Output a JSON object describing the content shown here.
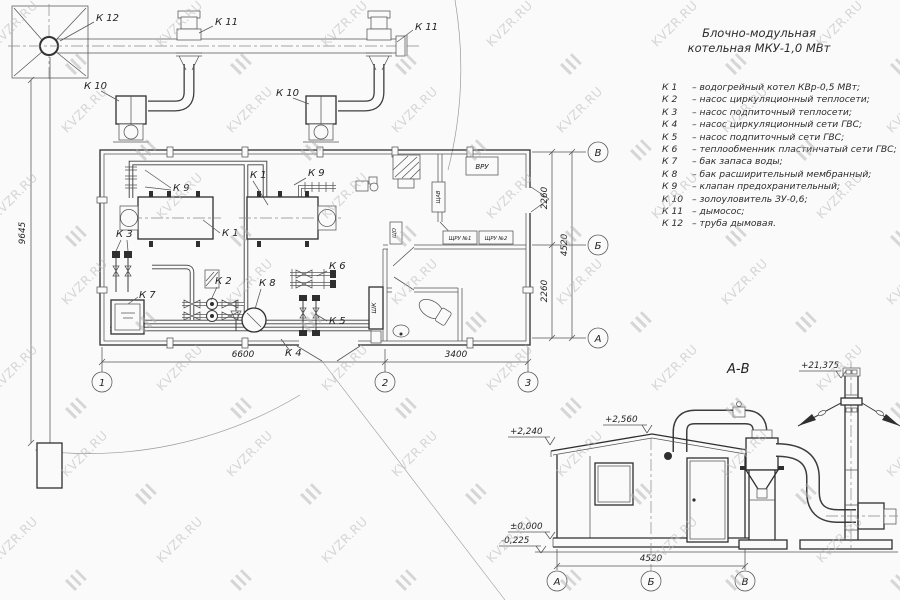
{
  "watermark": {
    "text": "KVZR.RU"
  },
  "legend": {
    "title_line1": "Блочно-модульная",
    "title_line2": "котельная МКУ-1,0 МВт",
    "items": [
      {
        "code": "К 1",
        "desc": "–  водогрейный котел КВр-0,5 МВт;"
      },
      {
        "code": "К 2",
        "desc": "–  насос циркуляционный теплосети;"
      },
      {
        "code": "К 3",
        "desc": "–  насос подпиточный теплосети;"
      },
      {
        "code": "К 4",
        "desc": "–  насос циркуляционный сети ГВС;"
      },
      {
        "code": "К 5",
        "desc": "–  насос подпиточный сети ГВС;"
      },
      {
        "code": "К 6",
        "desc": "–  теплообменник пластинчатый сети ГВС;"
      },
      {
        "code": "К 7",
        "desc": "–  бак запаса воды;"
      },
      {
        "code": "К 8",
        "desc": "–  бак расширительный мембранный;"
      },
      {
        "code": "К 9",
        "desc": "–  клапан предохранительный;"
      },
      {
        "code": "К 10",
        "desc": "–  золоуловитель ЗУ-0,6;"
      },
      {
        "code": "К 11",
        "desc": "–  дымосос;"
      },
      {
        "code": "К 12",
        "desc": "–  труба дымовая."
      }
    ]
  },
  "plan": {
    "labels": {
      "k12": "К 12",
      "k11_left": "К 11",
      "k11_right": "К 11",
      "k10_left": "К 10",
      "k10_right": "К 10",
      "k9_left": "К 9",
      "k9_right": "К 9",
      "k1_top": "К 1",
      "k1_bottom": "К 1",
      "k2": "К 2",
      "k3": "К 3",
      "k4": "К 4",
      "k5": "К 5",
      "k6": "К 6",
      "k7": "К 7",
      "k8": "К 8"
    },
    "panels": {
      "vru": "ВРУ",
      "shru1": "ЩРУ №1",
      "shru2": "ЩРУ №2",
      "shav": "ЩАВ",
      "sho": "ЩО",
      "shk": "ШК"
    },
    "dims": {
      "span1": "6600",
      "span2": "3400",
      "depth1": "2260",
      "depth2": "2260",
      "depth_total": "4520",
      "chimney_offset": "9645"
    },
    "axes": {
      "n1": "1",
      "n2": "2",
      "n3": "3",
      "v": "В",
      "b": "Б",
      "a": "А"
    }
  },
  "elevation": {
    "section_title": "А-В",
    "marks": {
      "ridge": "+2,560",
      "eaves": "+2,240",
      "zero": "±0,000",
      "below": "-0,225",
      "stack_top": "+21,375"
    },
    "dims": {
      "width": "4520"
    },
    "axes": {
      "a": "А",
      "b": "Б",
      "v": "В"
    }
  }
}
